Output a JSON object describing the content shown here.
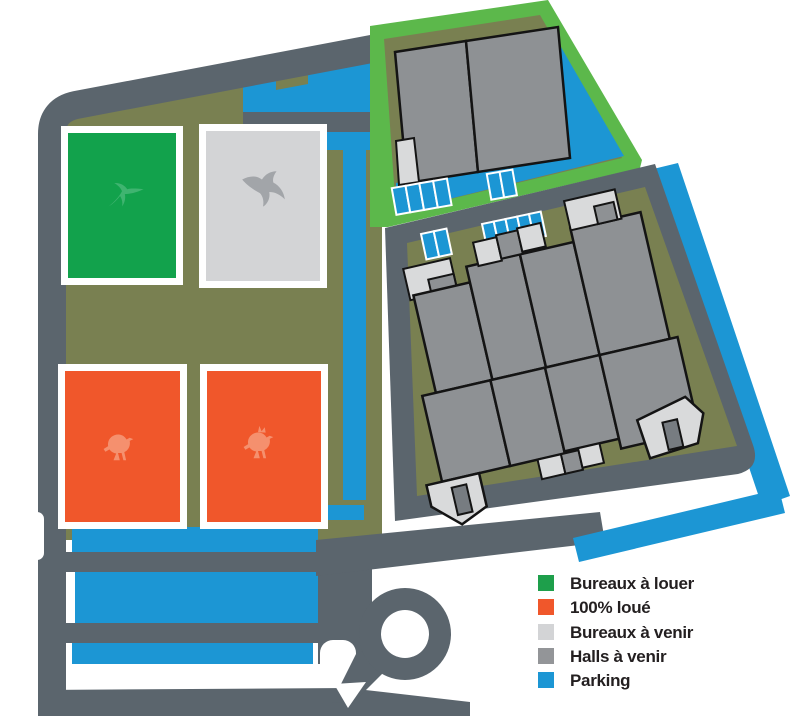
{
  "legend": {
    "items": [
      {
        "name": "bureaux-a-louer",
        "label": "Bureaux à louer",
        "color": "#1E9F4B"
      },
      {
        "name": "cent-pourcent-loue",
        "label": "100% loué",
        "color": "#F0572B"
      },
      {
        "name": "bureaux-a-venir",
        "label": "Bureaux à venir",
        "color": "#D3D4D6"
      },
      {
        "name": "halls-a-venir",
        "label": "Halls à venir",
        "color": "#939598"
      },
      {
        "name": "parking",
        "label": "Parking",
        "color": "#1C96D4"
      }
    ]
  },
  "map": {
    "palette": {
      "bg": "#FFFFFF",
      "road": "#5B656D",
      "land": "#798051",
      "parking": "#1C96D4",
      "green_border": "#5CB84B",
      "office_green": "#12A24C",
      "office_gray": "#D3D4D6",
      "orange": "#F0572B",
      "hall_gray": "#8E9194",
      "hall_light": "#D9DADB",
      "hall_door": "#777C81",
      "outline": "#141414"
    },
    "buildings": [
      {
        "icon": "hummingbird-icon",
        "status": "Bureaux à louer"
      },
      {
        "icon": "seagull-icon",
        "status": "Bureaux à venir"
      },
      {
        "icon": "sparrow-icon",
        "status": "100% loué"
      },
      {
        "icon": "crested-bird-icon",
        "status": "100% loué"
      }
    ]
  }
}
